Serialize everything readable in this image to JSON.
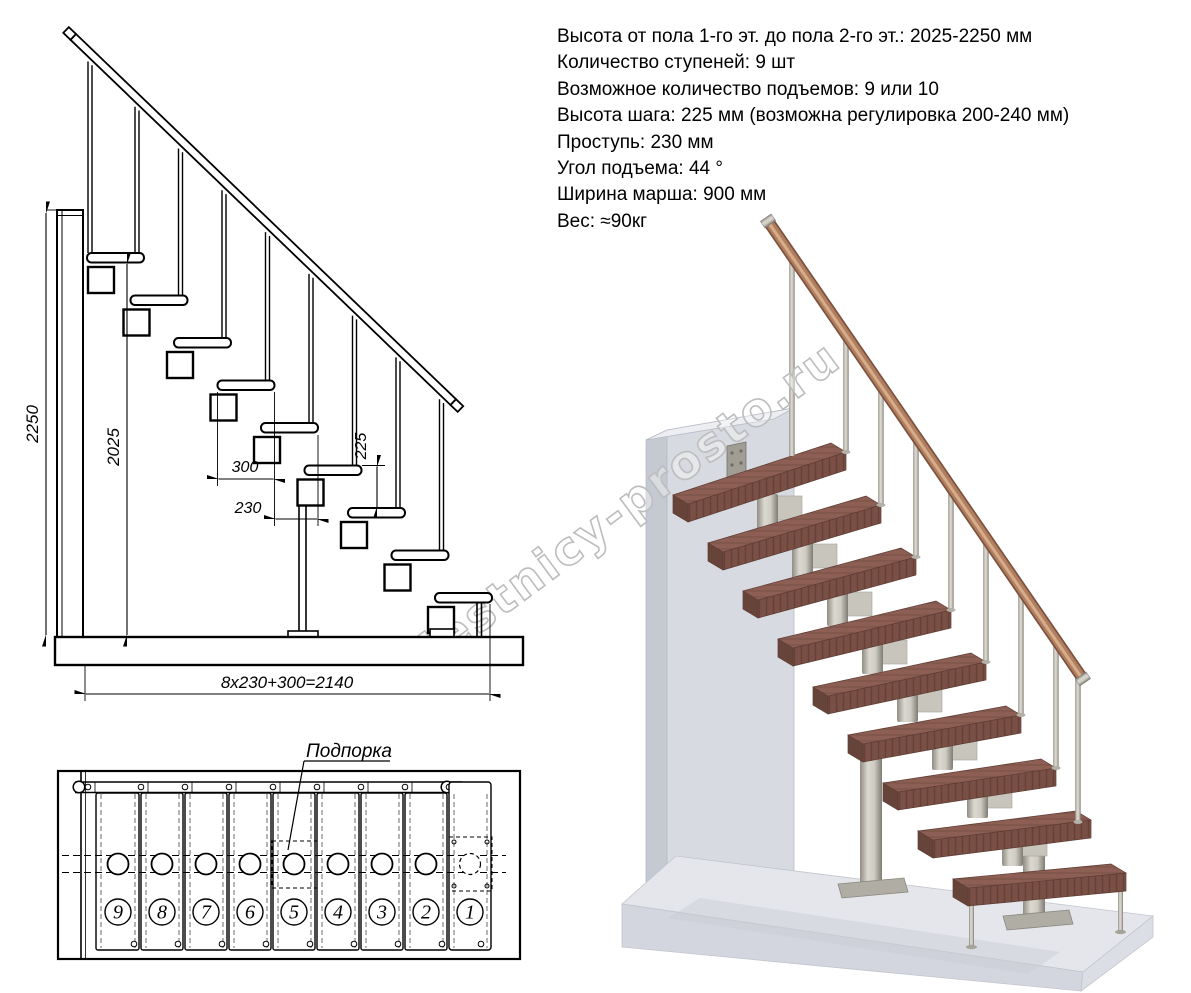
{
  "specs": {
    "lines": [
      "Высота от пола 1-го эт. до пола 2-го эт.: 2025-2250 мм",
      "Количество ступеней: 9 шт",
      "Возможное количество подъемов: 9 или 10",
      "Высота шага: 225 мм (возможна регулировка 200-240 мм)",
      "Проступь: 230 мм",
      "Угол подъема: 44 °",
      "Ширина марша: 900 мм",
      "Вес: ≈90кг"
    ]
  },
  "side_view": {
    "dim_floor_to_floor": "2250",
    "dim_stair_height": "2025",
    "dim_tread_depth": "300",
    "dim_going": "230",
    "dim_rise": "225",
    "dim_total_run": "8x230+300=2140"
  },
  "plan_view": {
    "support_label": "Подпорка",
    "step_numbers": [
      "9",
      "8",
      "7",
      "6",
      "5",
      "4",
      "3",
      "2",
      "1"
    ]
  },
  "watermark": "lestnicy-prosto.ru",
  "colors": {
    "line": "#000000",
    "tread_wood": "#8d5f54",
    "tread_front": "#7a5046",
    "handrail_wood": "#b07f5f",
    "metal": "#cfccc3",
    "wall": "#d7dae1",
    "floor": "#e4e6ec",
    "watermark_gray": "#bdbdbd"
  }
}
